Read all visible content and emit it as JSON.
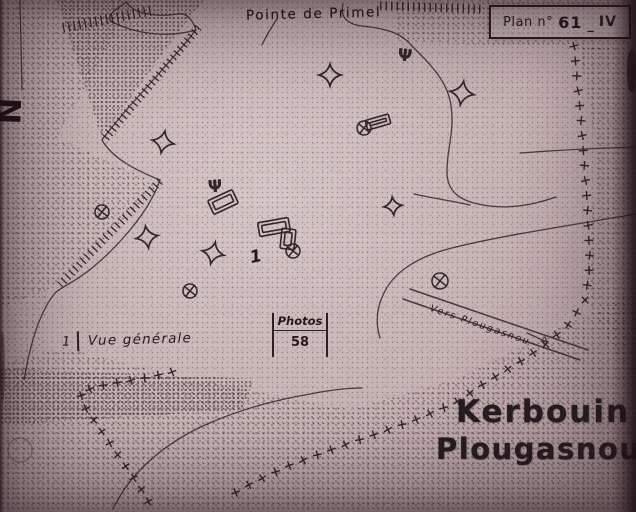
{
  "labels": {
    "pointe": "Pointe de Primel"
  },
  "plan": {
    "prefix": "Plan n°",
    "number": "61",
    "sep": "_",
    "suffix": "IV"
  },
  "annotations": {
    "vue_number": "1",
    "vue_label": "Vue générale",
    "photos_label": "Photos",
    "photos_number": "58",
    "road_label": "Vers Plougasnou",
    "site_number": "1"
  },
  "title": {
    "line1": "Kerbouin",
    "line2": "Plougasnou"
  },
  "compass": {
    "letter": "N"
  },
  "colors": {
    "paper": "#c6b2b3",
    "ink": "#32262a",
    "shadow": "#4a393d"
  },
  "icons": {
    "psi_glyph": "Ψ"
  },
  "map_features": {
    "stars": [
      {
        "x": 163,
        "y": 142,
        "s": 11,
        "rot": 10
      },
      {
        "x": 330,
        "y": 75,
        "s": 11,
        "rot": 0
      },
      {
        "x": 462,
        "y": 93,
        "s": 12,
        "rot": 8
      },
      {
        "x": 147,
        "y": 237,
        "s": 11,
        "rot": -8
      },
      {
        "x": 213,
        "y": 253,
        "s": 11,
        "rot": 12
      },
      {
        "x": 393,
        "y": 206,
        "s": 9,
        "rot": -5
      }
    ],
    "circle_crosses": [
      {
        "x": 102,
        "y": 212,
        "r": 7
      },
      {
        "x": 190,
        "y": 291,
        "r": 7
      },
      {
        "x": 440,
        "y": 281,
        "r": 8
      },
      {
        "x": 293,
        "y": 251,
        "r": 7
      },
      {
        "x": 364,
        "y": 128,
        "r": 7
      }
    ],
    "psi": [
      {
        "x": 405,
        "y": 55,
        "rot": 6
      },
      {
        "x": 215,
        "y": 186,
        "rot": -4
      }
    ],
    "monuments": [
      {
        "x": 223,
        "y": 202,
        "w": 27,
        "h": 15,
        "rot": -25
      },
      {
        "x": 274,
        "y": 227,
        "w": 31,
        "h": 14,
        "rot": -10
      },
      {
        "x": 288,
        "y": 239,
        "w": 14,
        "h": 20,
        "rot": 6
      },
      {
        "x": 378,
        "y": 122,
        "w": 24,
        "h": 10,
        "rot": -16
      }
    ],
    "boundary_cross_lines": [
      {
        "step": 15,
        "points": [
          [
            574,
            46
          ],
          [
            581,
            120
          ],
          [
            587,
            200
          ],
          [
            590,
            265
          ],
          [
            585,
            300
          ],
          [
            568,
            325
          ],
          [
            545,
            345
          ],
          [
            518,
            363
          ],
          [
            488,
            381
          ],
          [
            455,
            403
          ],
          [
            415,
            420
          ],
          [
            370,
            436
          ],
          [
            325,
            452
          ],
          [
            288,
            466
          ],
          [
            252,
            483
          ],
          [
            224,
            499
          ]
        ]
      },
      {
        "step": 14,
        "points": [
          [
            172,
            372
          ],
          [
            140,
            379
          ],
          [
            108,
            384
          ],
          [
            80,
            392
          ],
          [
            84,
            406
          ],
          [
            93,
            419
          ],
          [
            102,
            432
          ],
          [
            111,
            445
          ],
          [
            120,
            458
          ],
          [
            129,
            471
          ],
          [
            138,
            484
          ],
          [
            146,
            497
          ],
          [
            152,
            508
          ]
        ]
      }
    ]
  }
}
